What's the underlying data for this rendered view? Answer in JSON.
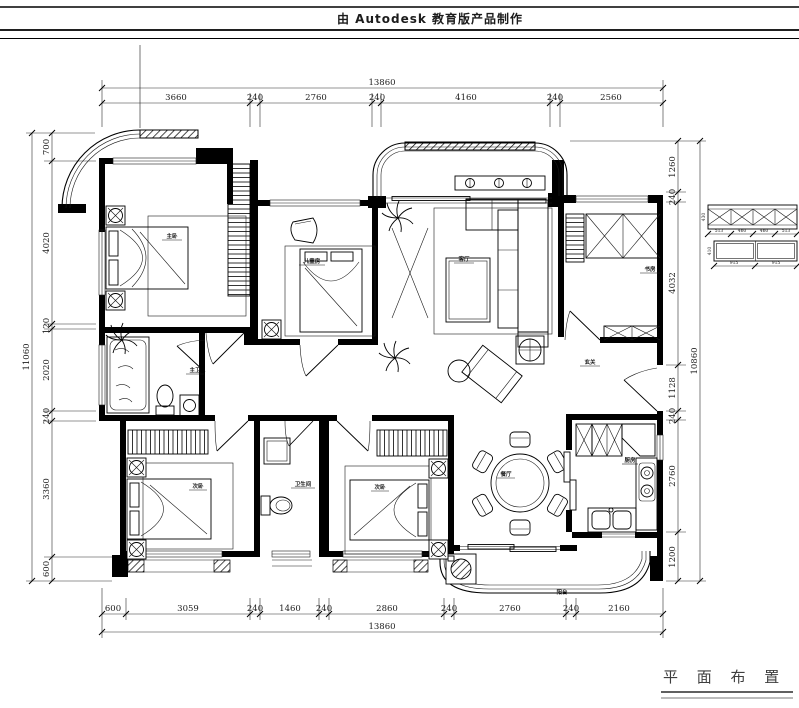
{
  "banner": {
    "text": "由 Autodesk 教育版产品制作"
  },
  "title": {
    "text": "平 面 布 置 图"
  },
  "dims": {
    "top_total": "13860",
    "top": [
      "3660",
      "240",
      "2760",
      "240",
      "4160",
      "240",
      "2560"
    ],
    "bottom": [
      "600",
      "3059",
      "240",
      "1460",
      "240",
      "2860",
      "240",
      "2760",
      "240",
      "2160"
    ],
    "bottom_total": "13860",
    "left": [
      "700",
      "4020",
      "120",
      "2020",
      "240",
      "3360",
      "600"
    ],
    "left_total": "11060",
    "right": [
      "1260",
      "240",
      "4032",
      "1128",
      "240",
      "2760",
      "1200"
    ],
    "right_total": "10860"
  },
  "rooms": {
    "master_bedroom": "主卧",
    "bedroom2": "儿童房",
    "living": "客厅",
    "study": "书房",
    "foyer": "玄关",
    "master_bath": "主卫",
    "bedroom3": "次卧",
    "bath2": "卫生间",
    "bedroom4": "次卧",
    "dining": "餐厅",
    "kitchen": "厨房",
    "balcony": "阳台"
  },
  "detail": {
    "top_dims": [
      "513",
      "460",
      "460",
      "513"
    ],
    "bottom_dims": [
      "915",
      "915"
    ],
    "side_dims": [
      "430",
      "410"
    ]
  }
}
